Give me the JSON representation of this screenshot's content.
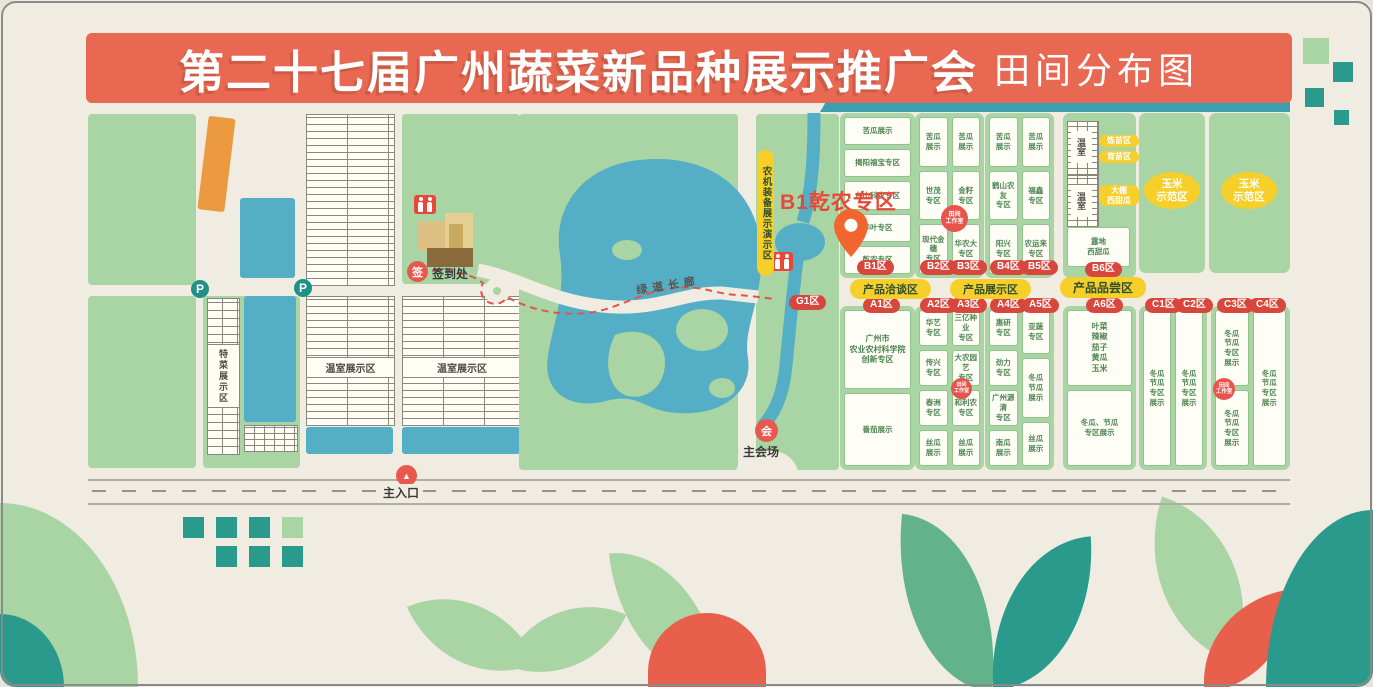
{
  "banner": {
    "title_main": "第二十七届广州蔬菜新品种展示推广会",
    "title_sub": "田间分布图"
  },
  "colors": {
    "background_cream": "#f1ece2",
    "banner_red": "#e96852",
    "field_green": "#a9d4a3",
    "teal": "#2a9a8c",
    "water_blue": "#54aec6",
    "pill_red": "#d8473d",
    "pill_yellow": "#f6cf2b",
    "pin_orange": "#f2652f",
    "accent_orange": "#ec9a3f"
  },
  "landmarks": {
    "parking_label": "P",
    "signin_icon": "签",
    "signin_label": "签到处",
    "greenway_label": "绿道长廊",
    "venue_icon": "会",
    "venue_label": "主会场",
    "entrance_arrow": "▲",
    "entrance_label": "主入口",
    "machinery_strip_label": "农机装备展示演示区",
    "special_veg_label": "特菜展示区",
    "greenhouse_area_label": "温室展示区",
    "greenhouse_label": "温室",
    "pin_label": "B1乾农专区",
    "workstation_badge": "田间\n工作室"
  },
  "pills": {
    "negotiation": "产品洽谈区",
    "display": "产品展示区",
    "tasting": "产品品尝区",
    "corn": "玉米\n示范区"
  },
  "zones": {
    "g1_label": "G1区",
    "b": [
      {
        "label": "B1区",
        "cells": [
          "苦瓜展示",
          "揭阳福宝专区",
          "台山科农专区",
          "华叶专区",
          "乾农专区"
        ]
      },
      {
        "label": "B2区",
        "cells": [
          "苦瓜\n展示",
          "世茂\n专区",
          "现代金穗\n专区"
        ]
      },
      {
        "label": "B3区",
        "cells": [
          "苦瓜\n展示",
          "金籽\n专区",
          "华农大\n专区"
        ]
      },
      {
        "label": "B4区",
        "cells": [
          "苦瓜\n展示",
          "鹤山农友\n专区",
          "阳兴\n专区"
        ]
      },
      {
        "label": "B5区",
        "cells": [
          "苦瓜\n展示",
          "福鑫\n专区",
          "农运来\n专区"
        ]
      },
      {
        "label": "B6区",
        "greenhouse_pills": [
          "炼苗区",
          "育苗区",
          "大棚\n西甜瓜"
        ],
        "field_cell": "露地\n西甜瓜"
      }
    ],
    "a": [
      {
        "label": "A1区",
        "cells": [
          "广州市\n农业农村科学院\n创新专区",
          "番茄展示"
        ]
      },
      {
        "label": "A2区",
        "cells": [
          "华艺\n专区",
          "传兴\n专区",
          "春洲\n专区",
          "丝瓜\n展示"
        ]
      },
      {
        "label": "A3区",
        "cells": [
          "三亿种业\n专区",
          "大农园艺\n专区",
          "和利农\n专区",
          "丝瓜\n展示"
        ]
      },
      {
        "label": "A4区",
        "cells": [
          "惠研\n专区",
          "劲力\n专区",
          "广州源清\n专区",
          "南瓜\n展示"
        ]
      },
      {
        "label": "A5区",
        "cells": [
          "亚蔬\n专区",
          "冬瓜\n节瓜\n展示",
          "丝瓜\n展示"
        ]
      },
      {
        "label": "A6区",
        "cells": [
          "叶菜\n辣椒\n茄子\n黄瓜\n玉米",
          "冬瓜、节瓜\n专区展示"
        ]
      }
    ],
    "c": [
      {
        "label": "C1区",
        "cells": [
          "冬瓜\n节瓜\n专区\n展示"
        ]
      },
      {
        "label": "C2区",
        "cells": [
          "冬瓜\n节瓜\n专区\n展示"
        ]
      },
      {
        "label": "C3区",
        "cells": [
          "冬瓜\n节瓜\n专区\n展示",
          "冬瓜\n节瓜\n专区\n展示"
        ]
      },
      {
        "label": "C4区",
        "cells": [
          "冬瓜\n节瓜\n专区\n展示"
        ]
      }
    ]
  }
}
